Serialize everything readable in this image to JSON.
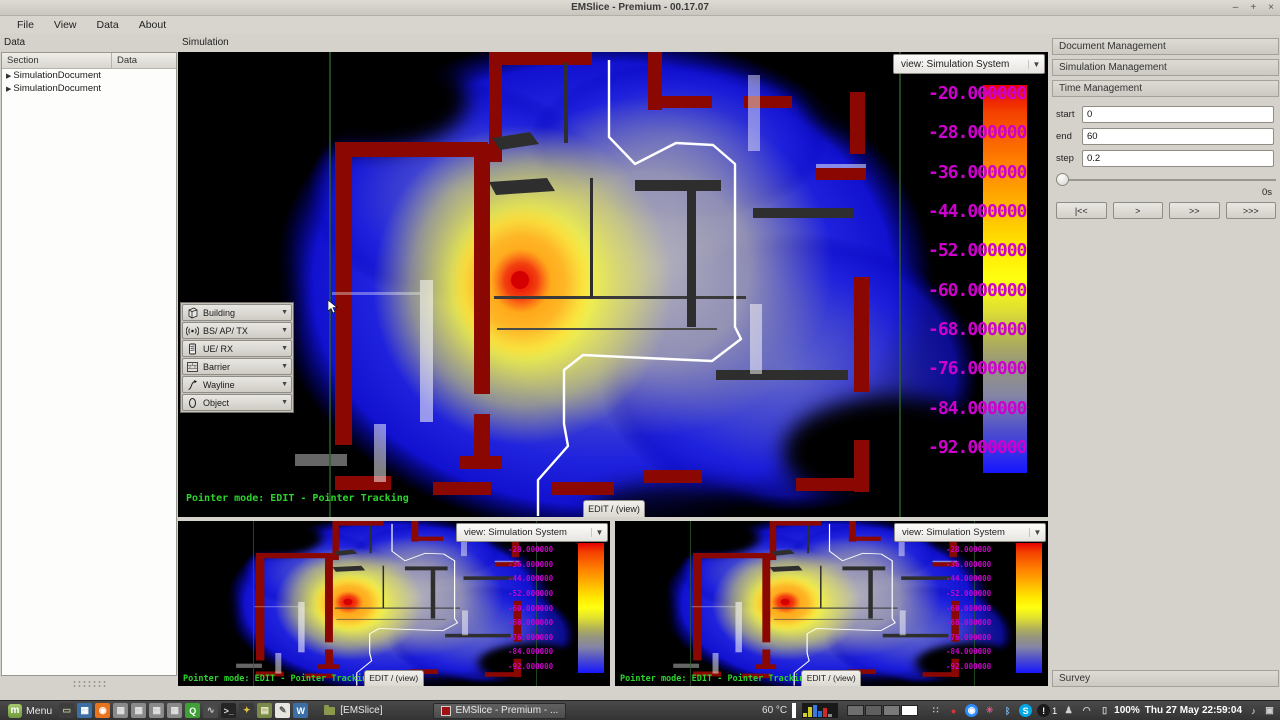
{
  "window": {
    "title": "EMSlice - Premium - 00.17.07",
    "minimize": "–",
    "maximize": "+",
    "close": "×"
  },
  "menu_bar": {
    "items": [
      "File",
      "View",
      "Data",
      "About"
    ]
  },
  "data_panel": {
    "title": "Data",
    "columns": [
      "Section",
      "Data"
    ],
    "rows": [
      "SimulationDocument",
      "SimulationDocument"
    ]
  },
  "simulation": {
    "title": "Simulation",
    "main_view": {
      "view_selector": "view: Simulation System",
      "pointer_mode": "Pointer mode: EDIT - Pointer Tracking",
      "edit_button": "EDIT / (view)",
      "tools": [
        {
          "label": "Building"
        },
        {
          "label": "BS/ AP/ TX"
        },
        {
          "label": "UE/ RX"
        },
        {
          "label": "Barrier"
        },
        {
          "label": "Wayline"
        },
        {
          "label": "Object"
        }
      ],
      "color_scale_labels": [
        "-20.000000",
        "-28.000000",
        "-36.000000",
        "-44.000000",
        "-52.000000",
        "-60.000000",
        "-68.000000",
        "-76.000000",
        "-84.000000",
        "-92.000000"
      ]
    },
    "sub_view_left": {
      "view_selector": "view: Simulation System",
      "pointer_mode": "Pointer mode: EDIT - Pointer Tracking",
      "edit_button": "EDIT / (view)",
      "color_scale_labels": [
        "-28.000000",
        "-36.000000",
        "-44.000000",
        "-52.000000",
        "-60.000000",
        "-68.000000",
        "-76.000000",
        "-84.000000",
        "-92.000000"
      ]
    },
    "sub_view_right": {
      "view_selector": "view: Simulation System",
      "pointer_mode": "Pointer mode: EDIT - Pointer Tracking",
      "edit_button": "EDIT / (view)",
      "color_scale_labels": [
        "-28.000000",
        "-36.000000",
        "-44.000000",
        "-52.000000",
        "-60.000000",
        "-68.000000",
        "-76.000000",
        "-84.000000",
        "-92.000000"
      ]
    }
  },
  "right_panel": {
    "sections": [
      "Document Management",
      "Simulation Management",
      "Time Management"
    ],
    "time": {
      "start_label": "start",
      "start_value": "0",
      "end_label": "end",
      "end_value": "60",
      "step_label": "step",
      "step_value": "0.2",
      "elapsed": "0s",
      "buttons": [
        "|<<",
        ">",
        ">>",
        ">>>"
      ]
    },
    "survey_section": "Survey"
  },
  "taskbar": {
    "menu_label": "Menu",
    "group_button": "[EMSlice]",
    "active_window": "EMSlice - Premium - ...",
    "temperature": "60 °C",
    "battery_percent": "100%",
    "clock": "Thu 27 May 22:59:04",
    "updates_count": "1",
    "app_icons": [
      {
        "name": "show-desktop-icon",
        "glyph": "▭",
        "bg": "#3d3d3d",
        "fg": "#b9c98e"
      },
      {
        "name": "image-viewer-icon",
        "glyph": "▦",
        "bg": "#3d6ea5",
        "fg": "#ffffff"
      },
      {
        "name": "firefox-icon",
        "glyph": "◉",
        "bg": "#e8741e",
        "fg": "#ffffff"
      },
      {
        "name": "window-grid-icon-1",
        "glyph": "▦",
        "bg": "#8a8a8a",
        "fg": "#e2e2e2"
      },
      {
        "name": "window-grid-icon-2",
        "glyph": "▦",
        "bg": "#8a8a8a",
        "fg": "#e2e2e2"
      },
      {
        "name": "window-grid-icon-3",
        "glyph": "▦",
        "bg": "#8a8a8a",
        "fg": "#e2e2e2"
      },
      {
        "name": "window-grid-icon-4",
        "glyph": "▦",
        "bg": "#8a8a8a",
        "fg": "#e2e2e2"
      },
      {
        "name": "quicklaunch-icon",
        "glyph": "Q",
        "bg": "#3fa037",
        "fg": "#ffffff"
      },
      {
        "name": "draw-tool-icon",
        "glyph": "∿",
        "bg": "#4a4a4a",
        "fg": "#c8c8c8"
      },
      {
        "name": "terminal-icon",
        "glyph": ">_",
        "bg": "#242424",
        "fg": "#dcdcdc"
      },
      {
        "name": "media-tool-icon",
        "glyph": "✦",
        "bg": "#3a3a3a",
        "fg": "#e0c040"
      },
      {
        "name": "folder-icon",
        "glyph": "▤",
        "bg": "#7a8a4a",
        "fg": "#eee8c8"
      },
      {
        "name": "text-editor-icon",
        "glyph": "✎",
        "bg": "#e8e6e0",
        "fg": "#555555"
      },
      {
        "name": "wiki-icon",
        "glyph": "W",
        "bg": "#3a6ea5",
        "fg": "#ffffff"
      }
    ],
    "tray_icons": [
      {
        "name": "dropbox-tray-icon",
        "glyph": "∷",
        "fg": "#c8c8c8"
      },
      {
        "name": "record-tray-icon",
        "glyph": "●",
        "fg": "#e03434"
      },
      {
        "name": "meeting-tray-icon",
        "glyph": "◉",
        "fg": "#ffffff",
        "bg": "#2d8cff"
      },
      {
        "name": "activity-tray-icon",
        "glyph": "✳",
        "fg": "#d85a8a"
      },
      {
        "name": "bluetooth-tray-icon",
        "glyph": "ᛒ",
        "fg": "#78b4f0"
      },
      {
        "name": "skype-tray-icon",
        "glyph": "S",
        "fg": "#ffffff",
        "bg": "#00a8e8"
      },
      {
        "name": "updates-tray-icon",
        "glyph": "!",
        "fg": "#ffffff",
        "bg": "#1a1a1a",
        "badge": "1"
      },
      {
        "name": "user-tray-icon",
        "glyph": "♟",
        "fg": "#d0d0d0"
      },
      {
        "name": "wifi-tray-icon",
        "glyph": "◠",
        "fg": "#d0d0d0"
      },
      {
        "name": "battery-tray-icon",
        "glyph": "▯",
        "fg": "#d0d0d0"
      }
    ]
  },
  "colors": {
    "scale_label": "#cf00cf",
    "pointer_mode_text": "#2cd42c",
    "wall": "#8b0802",
    "hotspot_core": "#d40000",
    "scale_top": "#e60000",
    "scale_bottom": "#1616ff"
  }
}
